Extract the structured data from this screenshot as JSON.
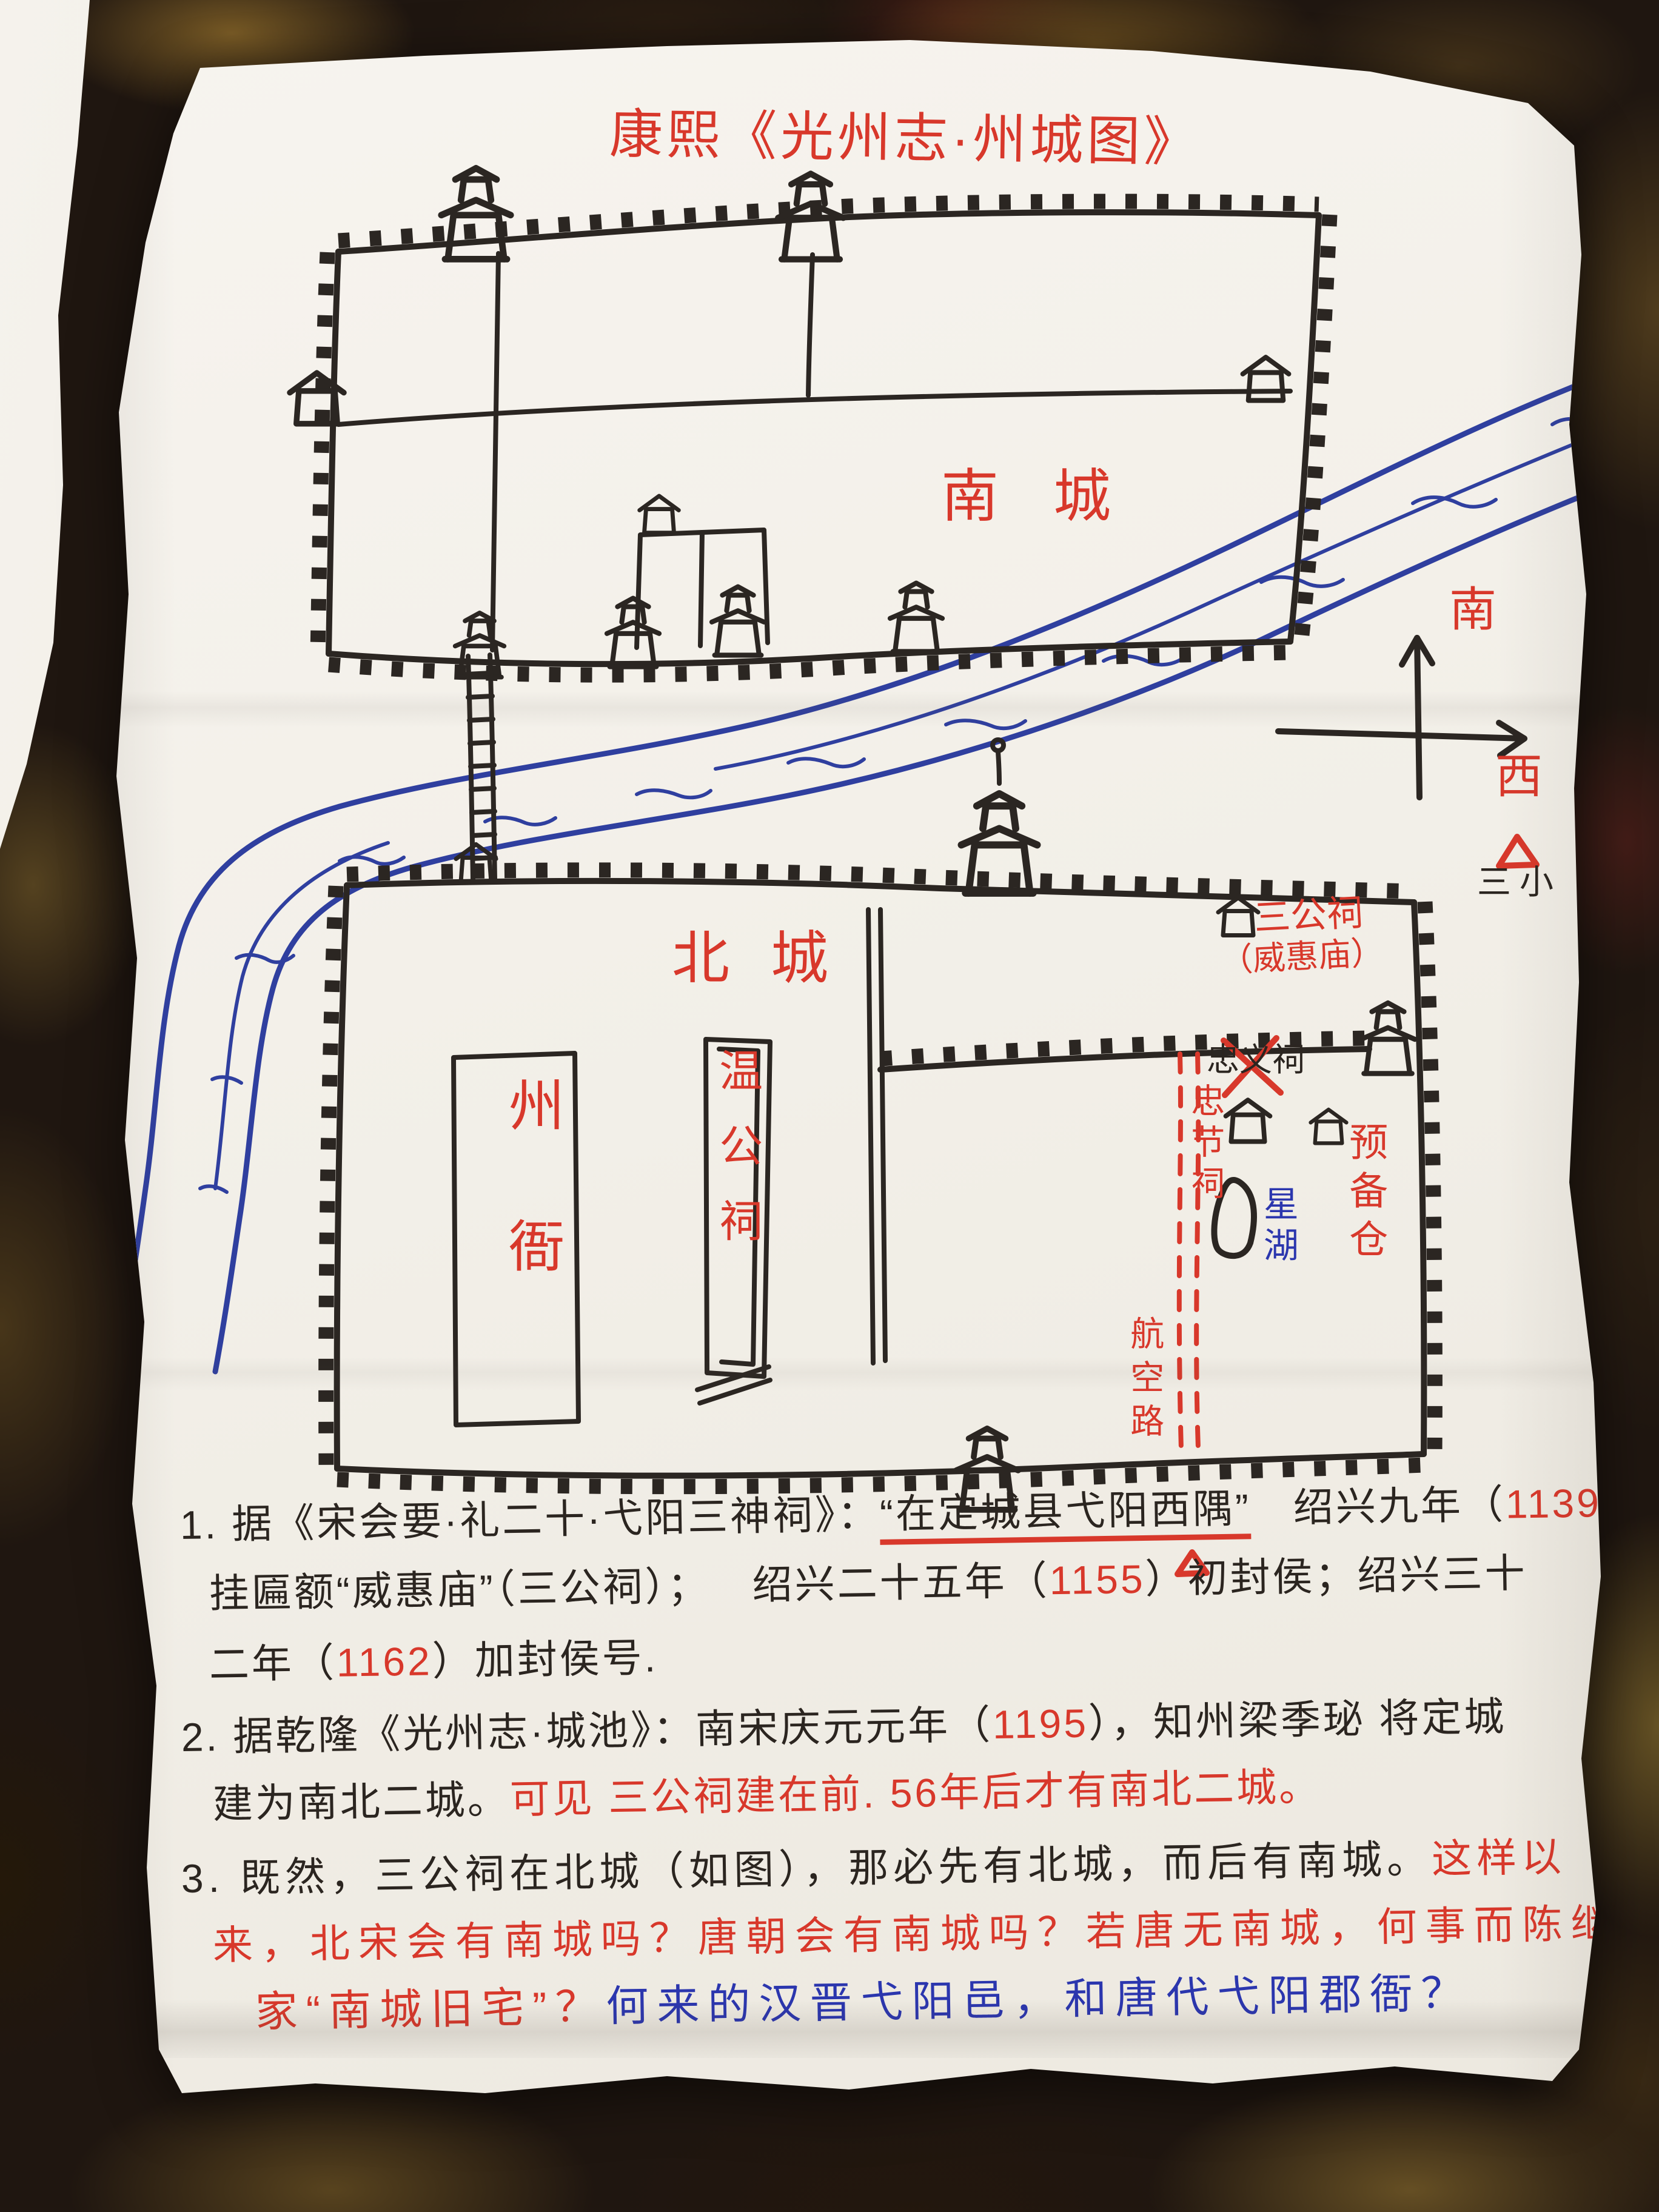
{
  "title": "康熙《光州志·州城图》",
  "colors": {
    "red_marker": "#d8382b",
    "black_ink": "#2b2622",
    "blue_pen": "#2b36ae",
    "river_blue": "#2f3f9f",
    "paper": "#f3f0e9"
  },
  "map": {
    "south_city": "南城",
    "north_city": "北城",
    "prefecture_yamen": "州衙",
    "wengong_shrine": "温公祠",
    "sangong_shrine": "三公祠",
    "sangong_shrine_alt": "（威惠庙）",
    "zhongyi_shrine_crossed_out": "忠义祠",
    "zhongjie_shrine": "忠节祠",
    "star_lake": "星湖",
    "granary": "预备仓",
    "aviation_road": "航空路",
    "compass_up": "南",
    "compass_right": "西",
    "third_primary_school": "三小"
  },
  "notes": {
    "n1l1a": "1. 据《宋会要·礼二十·弋阳三神祠》：",
    "n1l1b": "“在定城县弋阳西隅”",
    "n1l1c": "绍兴九年（",
    "n1l1d": "1139",
    "n1l1e": "）",
    "n1l2a": "挂匾额“威惠庙”（三公祠）；",
    "n1l2b": "绍兴二十五年（",
    "n1l2c": "1155",
    "n1l2d": "）初封侯；绍兴三十",
    "n1l3a": "二年（",
    "n1l3b": "1162",
    "n1l3c": "）加封侯号.",
    "n2l1a": "2. 据乾隆《光州志·城池》：南宋庆元元年（",
    "n2l1b": "1195",
    "n2l1c": "），知州梁季珌 将定城",
    "n2l2a": "建为南北二城。",
    "n2l2b": "可见 三公祠建在前. 56年后才有南北二城。",
    "n3l1a": "3. 既然，三公祠在北城（如图），那必先有北城，而后有南城。",
    "n3l1b": "这样以",
    "n3l2": "来，北宋会有南城吗？唐朝会有南城吗？若唐无南城，何事而陈继",
    "n3l3a": "家“南城旧宅”？",
    "n3l3b": "何来的汉晋弋阳邑，和唐代弋阳郡衙？"
  }
}
